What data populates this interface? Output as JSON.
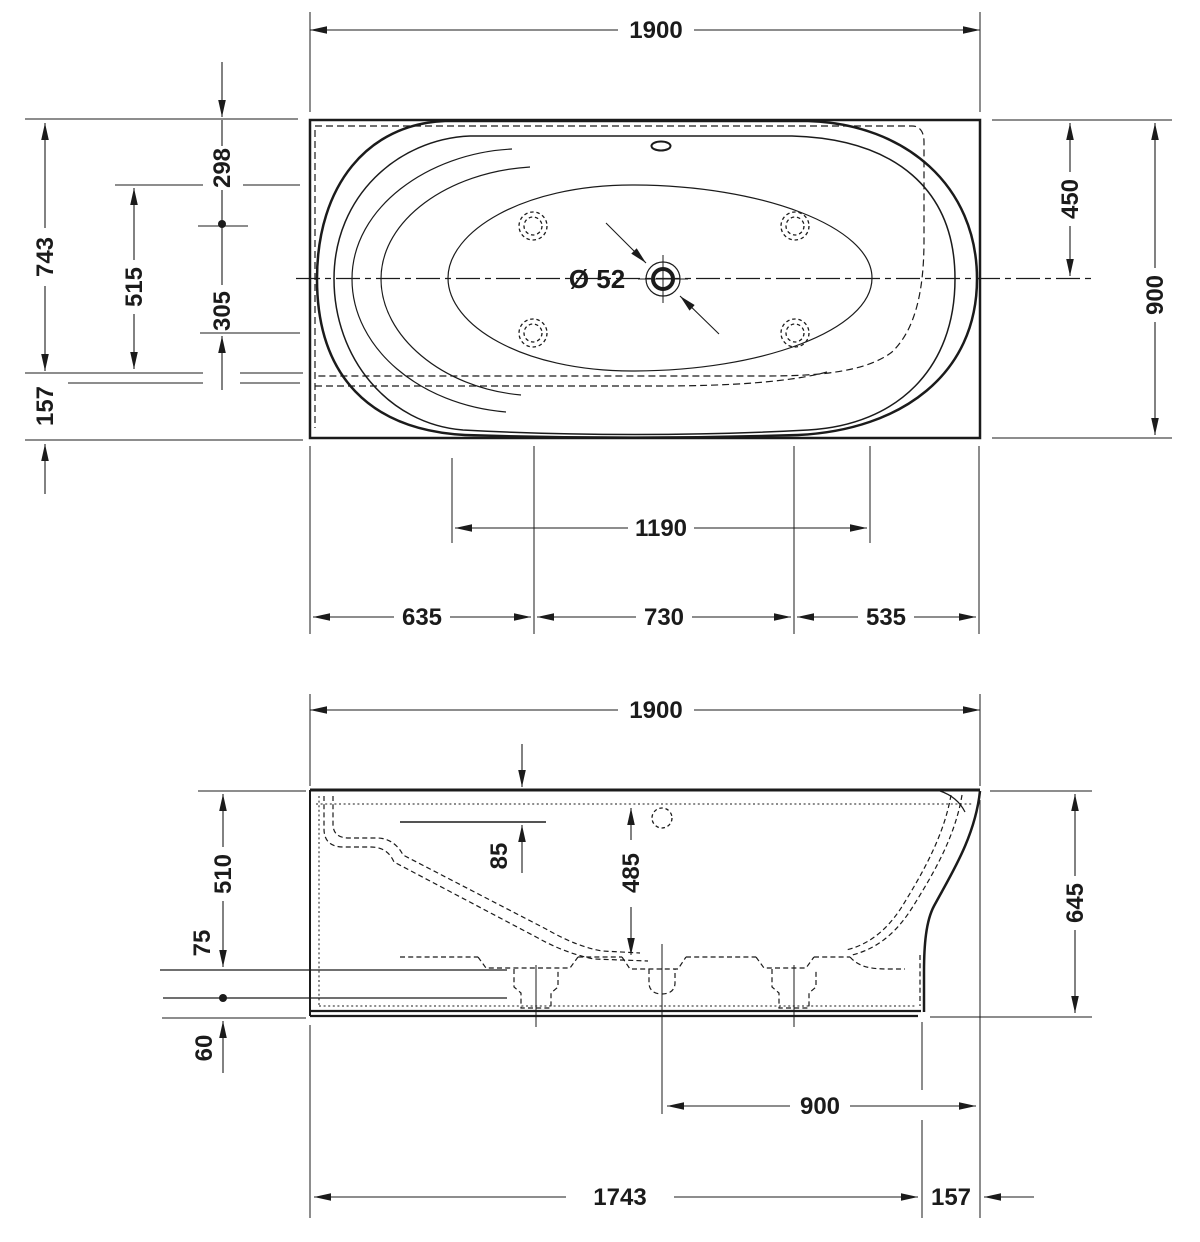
{
  "canvas": {
    "width": 1200,
    "height": 1242,
    "background": "#ffffff",
    "ink": "#1b1b1b"
  },
  "drawing": {
    "kind": "technical-drawing",
    "subject": "bathtub",
    "views": {
      "plan": {
        "label": "top-view",
        "dims": {
          "overall_length": "1900",
          "overall_depth": "900",
          "wall_to_centerline": "450",
          "wall_to_front_tangent": "743",
          "front_edge_offset": "157",
          "wall_to_jet_row": "298",
          "jet_row_spacing": "305",
          "basin_width": "515",
          "basin_floor_length": "1190",
          "left_edge_to_jets": "635",
          "jet_columns_spacing": "730",
          "jets_to_right_edge": "535",
          "drain_diameter": "Ø 52"
        }
      },
      "side": {
        "label": "side-view",
        "dims": {
          "overall_length": "1900",
          "rim_to_overflow_level": "85",
          "inner_depth": "485",
          "left_height_upper": "510",
          "floor_band": "75",
          "base_band": "60",
          "overall_height": "645",
          "drain_to_right_edge": "900",
          "base_length": "1743",
          "right_overhang": "157"
        }
      }
    }
  }
}
